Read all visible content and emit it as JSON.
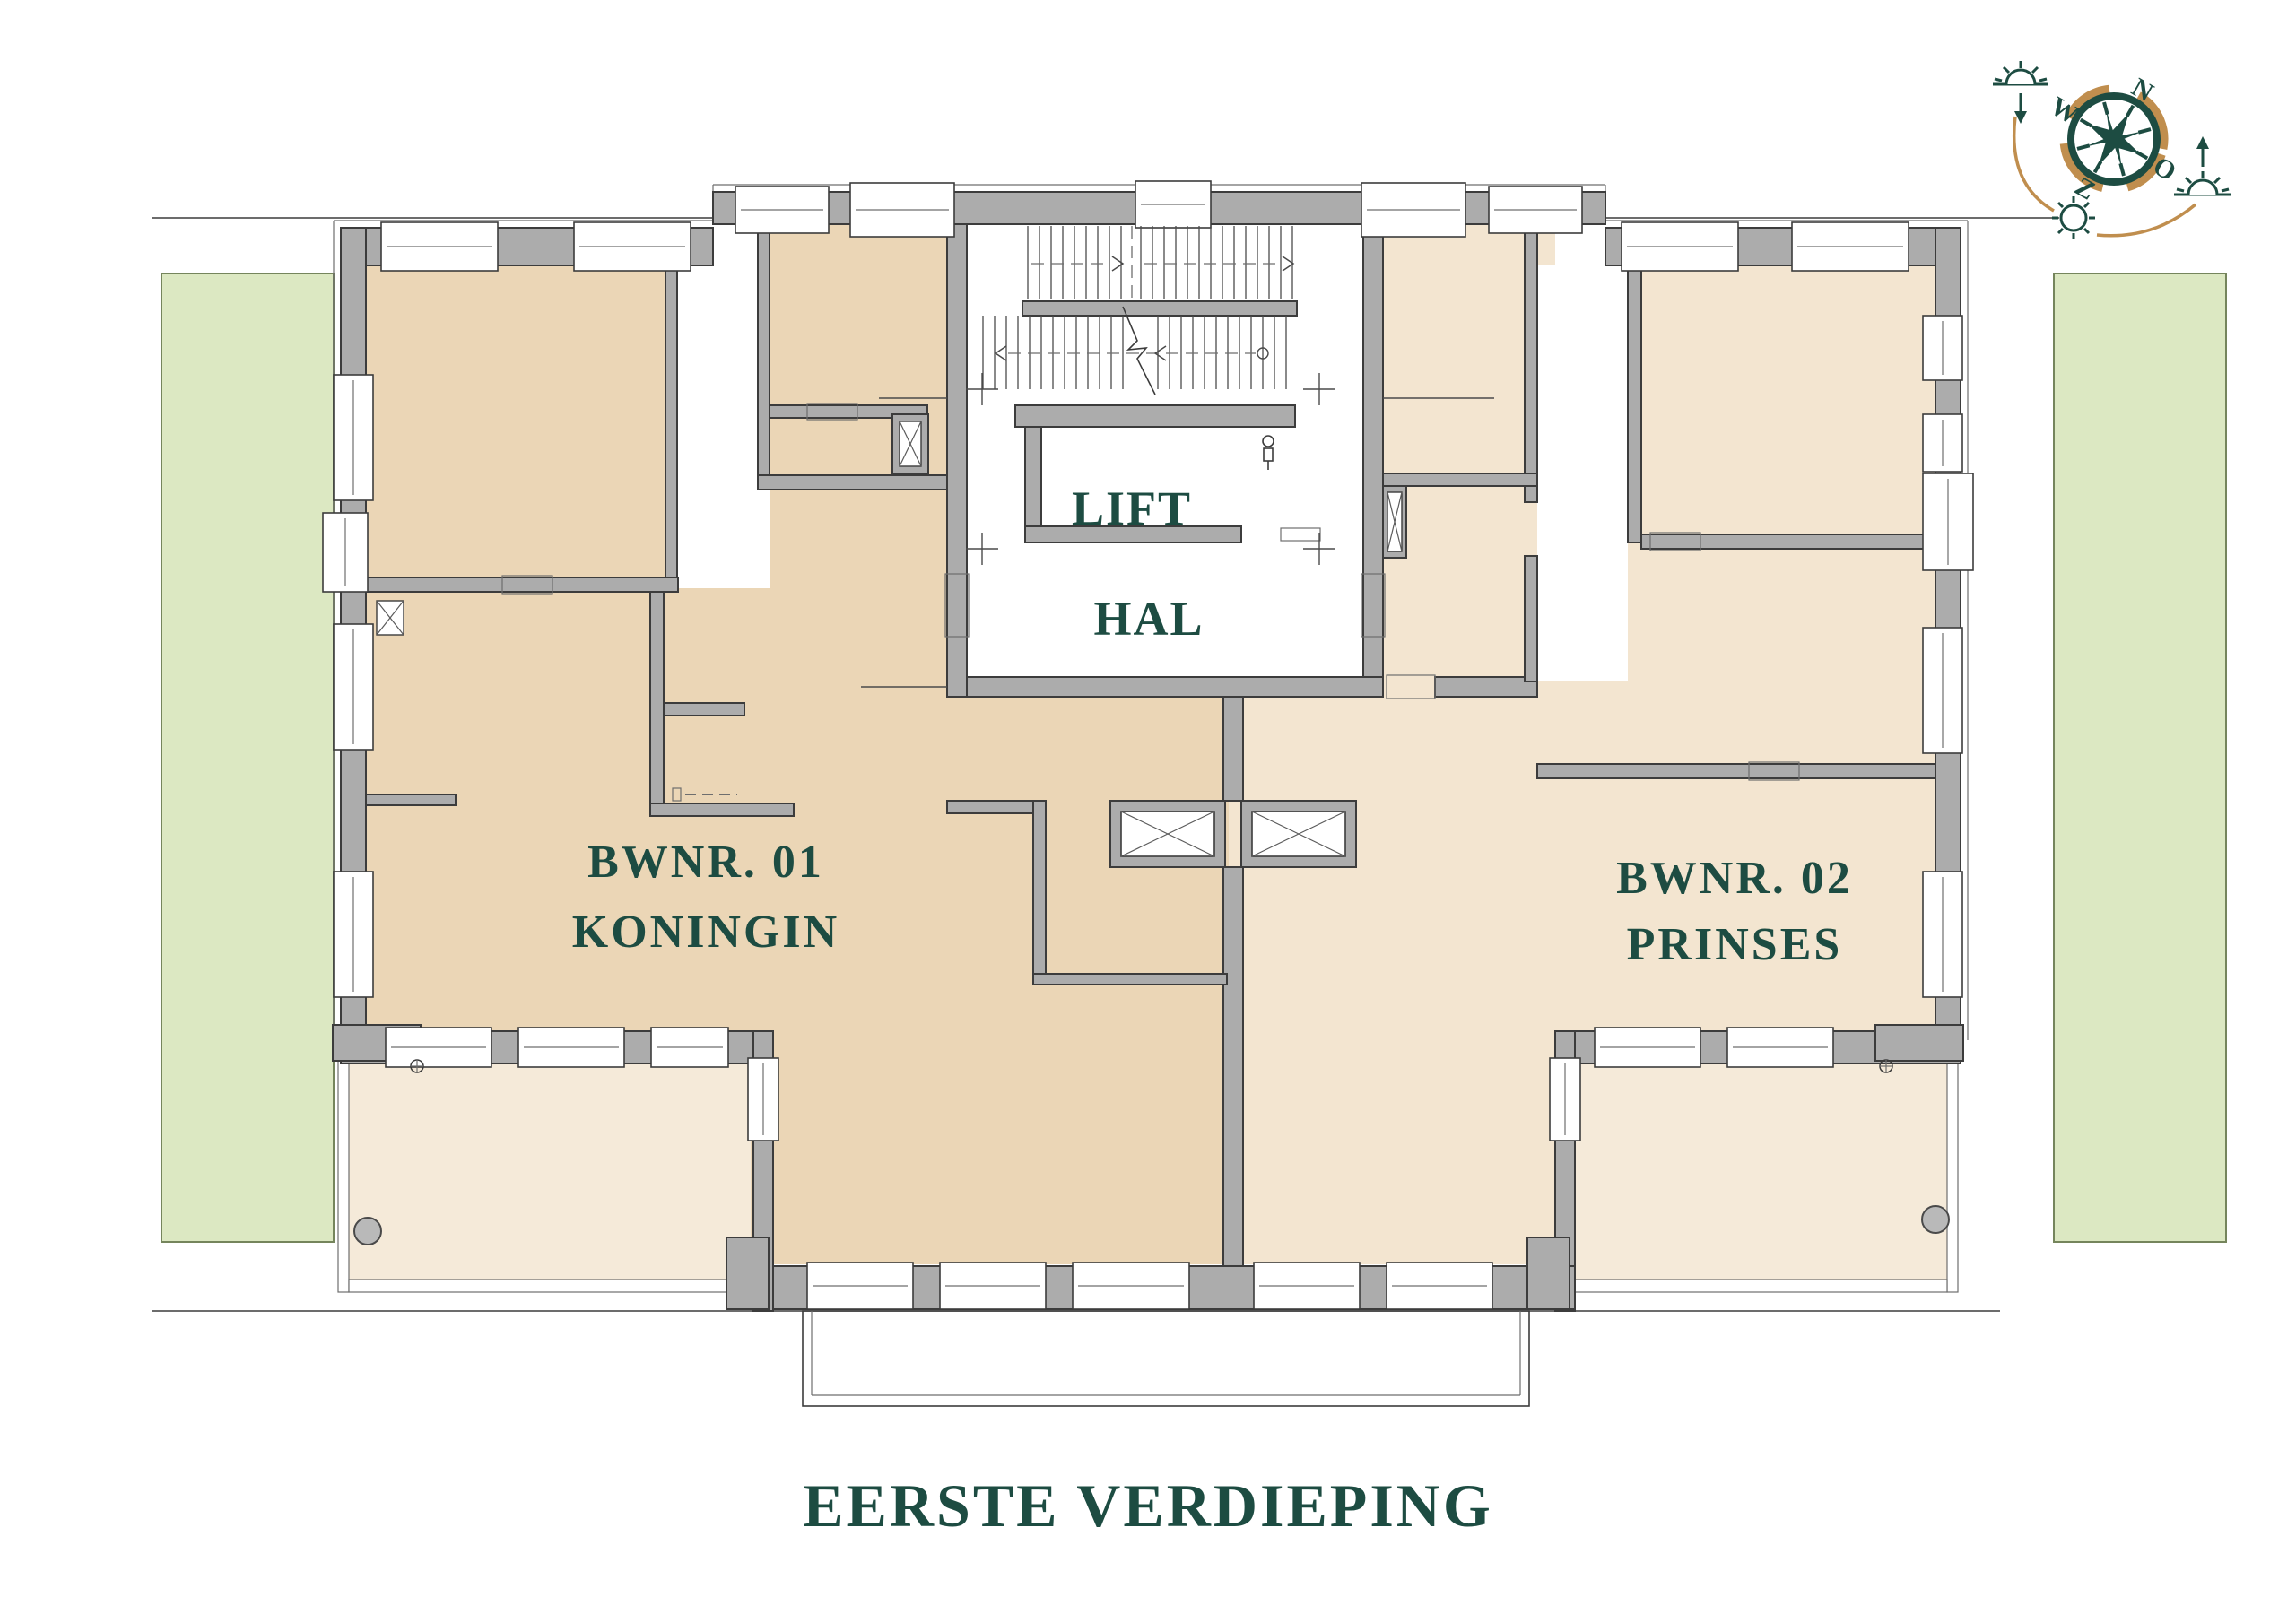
{
  "title": "EERSTE VERDIEPING",
  "units": {
    "unit1": {
      "number": "BWNR. 01",
      "name": "KONINGIN"
    },
    "unit2": {
      "number": "BWNR. 02",
      "name": "PRINSES"
    }
  },
  "rooms": {
    "lift": "LIFT",
    "hal": "HAL"
  },
  "compass": {
    "n": "N",
    "o": "O",
    "z": "Z",
    "w": "W"
  },
  "colors": {
    "teal": "#1d4c42",
    "gold": "#c08e4e",
    "floor_unit1": "#ebd6b6",
    "floor_unit2": "#f3e5d0",
    "floor_terrace": "#f5ead9",
    "green_area": "#dce8c2",
    "green_border": "#75855c",
    "wall_gray": "#acacac",
    "wall_light": "#c9c9c9",
    "line_dark": "#3c3c3c"
  }
}
